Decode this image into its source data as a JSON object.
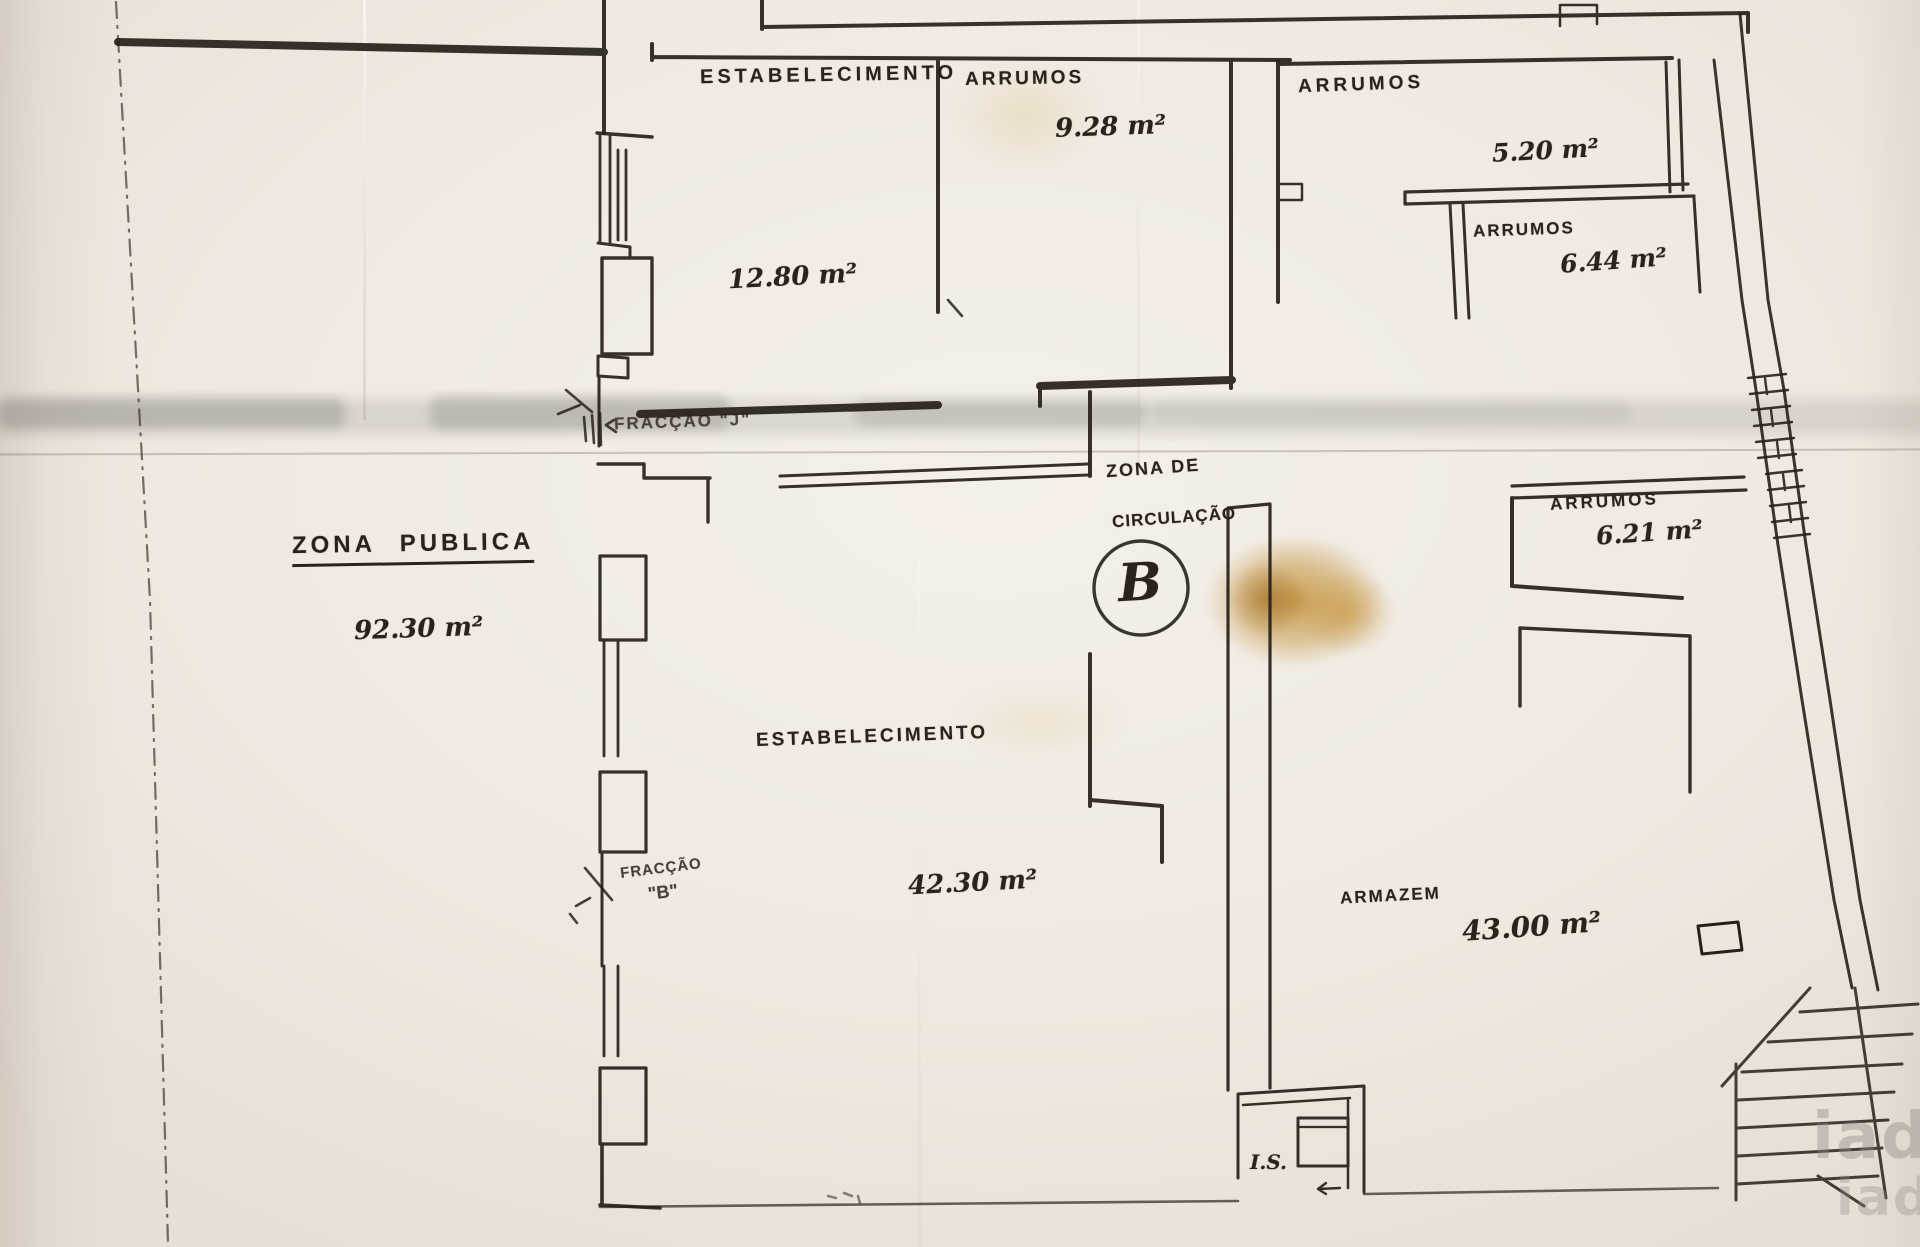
{
  "colors": {
    "ink": "#262019",
    "paper": "#efe9e1",
    "stain": "#b9821f",
    "band_gray": "#7d7a76"
  },
  "plan": {
    "labels": {
      "estab_top_name": "ESTABELECIMENTO",
      "arrumos_top_name": "ARRUMOS",
      "arrumos_top_area": "9.28 m²",
      "room_1280_area": "12.80 m²",
      "arrumos_ne_name": "ARRUMOS",
      "arrumos_ne_area": "5.20 m²",
      "arrumos_e_name": "ARRUMOS",
      "arrumos_e_area": "6.44 m²",
      "fraccao_j": "FRACÇÃO \"J\"",
      "zona_circ_line1": "ZONA DE",
      "zona_circ_line2": "CIRCULAÇÃO",
      "unit_letter": "B",
      "arrumos_se_name": "ARRUMOS",
      "arrumos_se_area": "6.21 m²",
      "zona_publica_name": "ZONA PUBLICA",
      "zona_publica_area": "92.30 m²",
      "estab_main_name": "ESTABELECIMENTO",
      "estab_main_area": "42.30 m²",
      "fraccao_b_line1": "FRACÇÃO",
      "fraccao_b_line2": "\"B\"",
      "armazem_name": "ARMAZEM",
      "armazem_area": "43.00 m²",
      "is_name": "I.S.",
      "watermark": "iad"
    }
  }
}
